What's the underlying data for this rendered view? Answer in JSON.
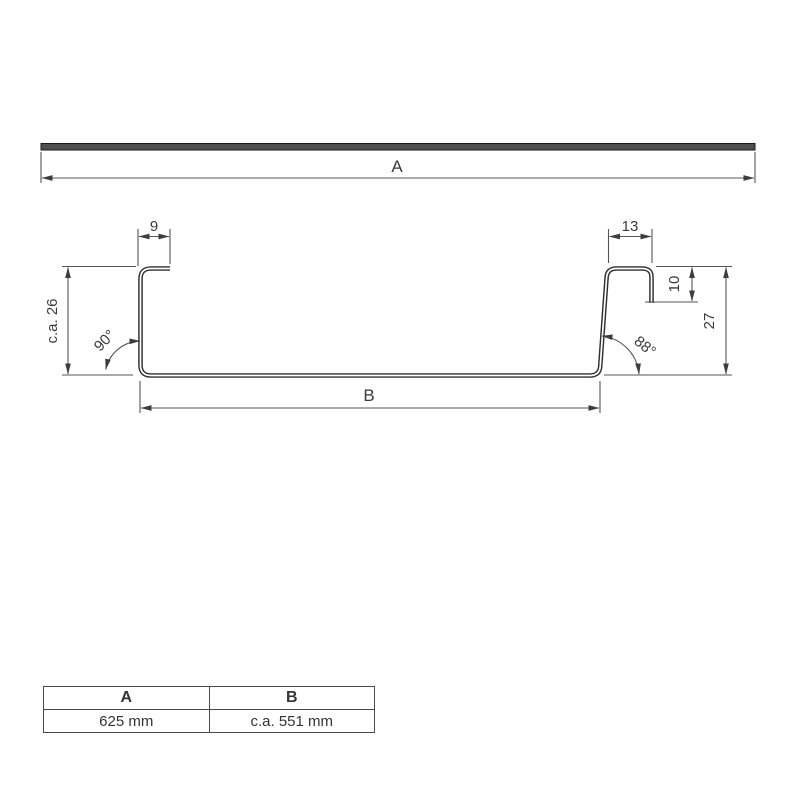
{
  "drawing": {
    "kind": "sheet-metal-profile-technical-drawing",
    "top_view": {
      "width_label": "A"
    },
    "section": {
      "left_lip_width": "9",
      "right_lip_width": "13",
      "left_height": "c.a. 26",
      "right_lip_height": "10",
      "right_height": "27",
      "base_width_label": "B",
      "left_angle": "90°",
      "right_angle": "88°"
    },
    "colors": {
      "line": "#555555",
      "profile": "#2f2f2f",
      "text": "#3a3a3a",
      "sheet_fill": "#4f4f4f"
    }
  },
  "table": {
    "headers": [
      "A",
      "B"
    ],
    "rows": [
      [
        "625 mm",
        "c.a. 551 mm"
      ]
    ]
  }
}
